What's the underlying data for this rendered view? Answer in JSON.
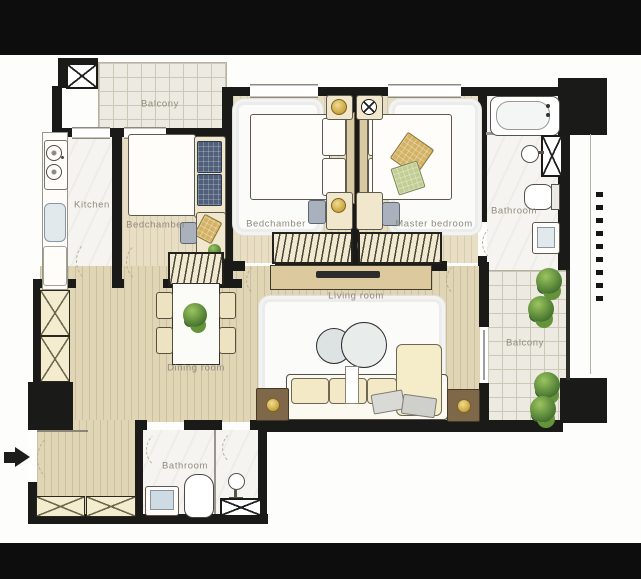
{
  "plan": {
    "labels": {
      "balcony_top": "Balcony",
      "kitchen": "Kitchen",
      "bedchamber_left": "Bedchamber",
      "bedchamber_center": "Bedchamber",
      "master_bedroom": "Master bedroom",
      "bathroom_top": "Bathroom",
      "living_room": "Living room",
      "dining_room": "Dining room",
      "bathroom_bottom": "Bathroom",
      "balcony_right": "Balcony"
    },
    "colors": {
      "wall": "#1a1a18",
      "letterbox_bar": "#0d0d0d",
      "wood_floor": "#e0d5b4",
      "wood_floor_light": "#e8dec4",
      "tile_floor": "#edebe1",
      "marble_floor": "#f5f4f0",
      "rug": "#fbfbfa",
      "gold_accent": "#c9a23c",
      "plant_green": "#4e7d33",
      "sofa_cream": "#f3e9c6",
      "console_wood": "#dcca9e",
      "side_table_brown": "#7e6849",
      "dark_cushion": "#51607a",
      "gold_cushion": "#d3b264",
      "green_cushion": "#c2cd94",
      "label_text": "#8f8a7c"
    },
    "icons": {
      "entry-arrow-icon": "solid black right-pointing arrow",
      "stove-icon": "two gas burner circles",
      "kitchen-sink-icon": "rounded basin",
      "bathtub-icon": "oval tub in frame",
      "toilet-icon": "rounded bowl with tank",
      "washbasin-icon": "circle with tap",
      "shower-pedestal-icon": "circle on stand",
      "bed-icon": "duvet with pillows",
      "wardrobe-icon": "hatched cabinet",
      "closet-x-icon": "crossed storage box",
      "shaft-x-icon": "crossed service shaft",
      "sofa-icon": "cushioned seat with chaise",
      "coffee-table-icon": "round marble table",
      "tv-console-icon": "sideboard with dark TV slab",
      "side-table-icon": "brown table with gold lamp",
      "lamp-icon": "gold circle lamp",
      "dining-table-icon": "marble table with plant",
      "chair-icon": "small rounded seat",
      "plant-icon": "green bush cluster",
      "window-icon": "triple-line glazing band",
      "door-arc-icon": "dashed quarter-circle swing"
    }
  }
}
